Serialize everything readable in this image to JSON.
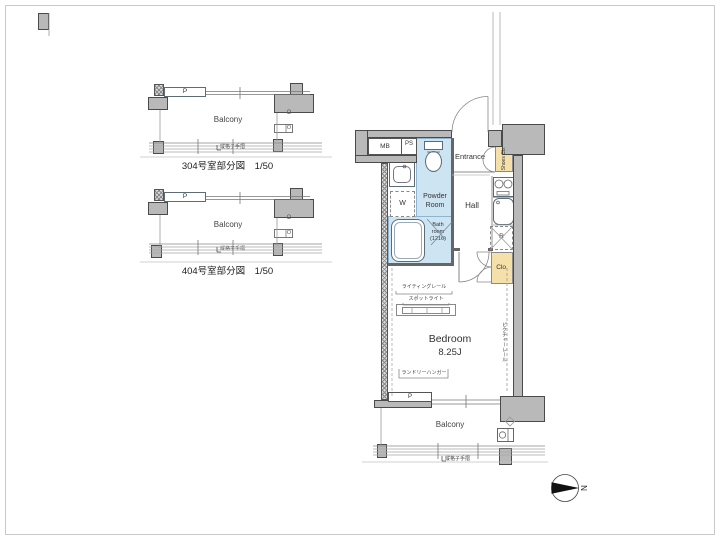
{
  "colors": {
    "wall": "#b9b9b9",
    "wet_area": "#cde4f3",
    "storage": "#f5e0a9",
    "line": "#555555"
  },
  "partials": [
    {
      "p": "P",
      "balcony": "Balcony",
      "o_mark": "O",
      "o_box": "O",
      "railing": "縦格子手摺",
      "caption": "304号室部分図　1/50"
    },
    {
      "p": "P",
      "balcony": "Balcony",
      "o_mark": "O",
      "o_box": "O",
      "railing": "縦格子手摺",
      "caption": "404号室部分図　1/50"
    }
  ],
  "main": {
    "mb": "MB",
    "ps": "PS",
    "entrance": "Entrance",
    "shoes_cb": "Shoes Cb.",
    "hall": "Hall",
    "powder_room": "Powder Room",
    "washer": "W",
    "bath_room": "Bath room (1216)",
    "fridge": "R",
    "closet": "Clo.",
    "bedroom": "Bedroom",
    "bedroom_size": "8.25J",
    "lighting_rail": "ライティングレール",
    "spotlight": "スポットライト",
    "laundry_hanger": "ランドリーハンガー",
    "picture_rail": "ピクチャーレール",
    "p": "P",
    "balcony": "Balcony",
    "railing": "縦格子手摺"
  },
  "compass": {
    "north": "N"
  }
}
